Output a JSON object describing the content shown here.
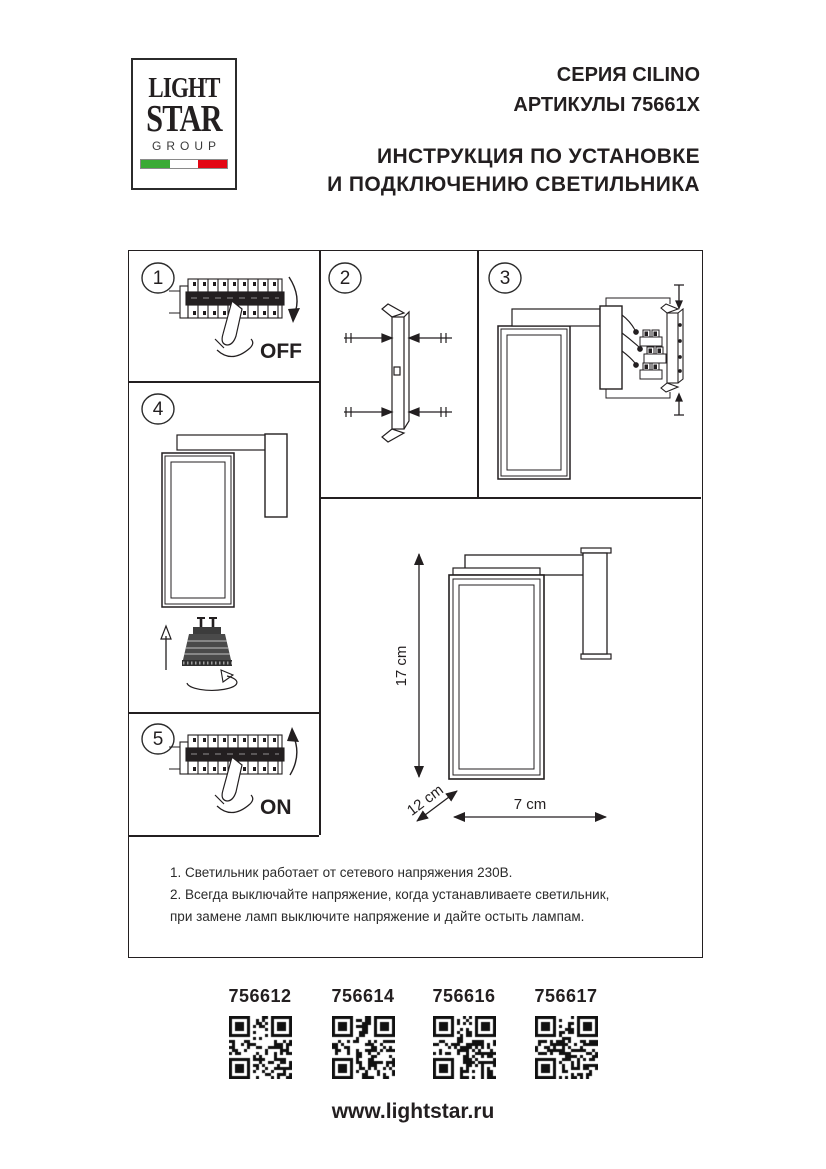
{
  "page": {
    "background": "#ffffff",
    "ink": "#231f20"
  },
  "logo": {
    "line1": "LIGHT",
    "line2": "STAR",
    "line3": "GROUP",
    "flag_colors": {
      "green": "#3aaa35",
      "white": "#ffffff",
      "red": "#e30613"
    }
  },
  "header": {
    "series": "СЕРИЯ CILINO",
    "articles": "АРТИКУЛЫ 75661X",
    "title_line1": "ИНСТРУКЦИЯ ПО УСТАНОВКЕ",
    "title_line2": "И ПОДКЛЮЧЕНИЮ СВЕТИЛЬНИКА"
  },
  "steps": [
    {
      "number": "1",
      "action_label": "OFF",
      "description": "turn power off at breaker"
    },
    {
      "number": "2",
      "action_label": "",
      "description": "fix mounting bracket with screws"
    },
    {
      "number": "3",
      "action_label": "",
      "description": "connect wires to terminal blocks"
    },
    {
      "number": "4",
      "action_label": "",
      "description": "insert GU10 lamp and rotate"
    },
    {
      "number": "5",
      "action_label": "ON",
      "description": "turn power on at breaker"
    }
  ],
  "dimensions": {
    "height": "17 cm",
    "depth": "12 cm",
    "width": "7 cm"
  },
  "notes": {
    "line1": "1. Светильник работает от сетевого напряжения 230В.",
    "line2": "2. Всегда выключайте напряжение, когда устанавливаете светильник,",
    "line3": "при замене ламп выключите напряжение и дайте остыть лампам."
  },
  "products": [
    {
      "article": "756612"
    },
    {
      "article": "756614"
    },
    {
      "article": "756616"
    },
    {
      "article": "756617"
    }
  ],
  "footer": {
    "website": "www.lightstar.ru"
  }
}
